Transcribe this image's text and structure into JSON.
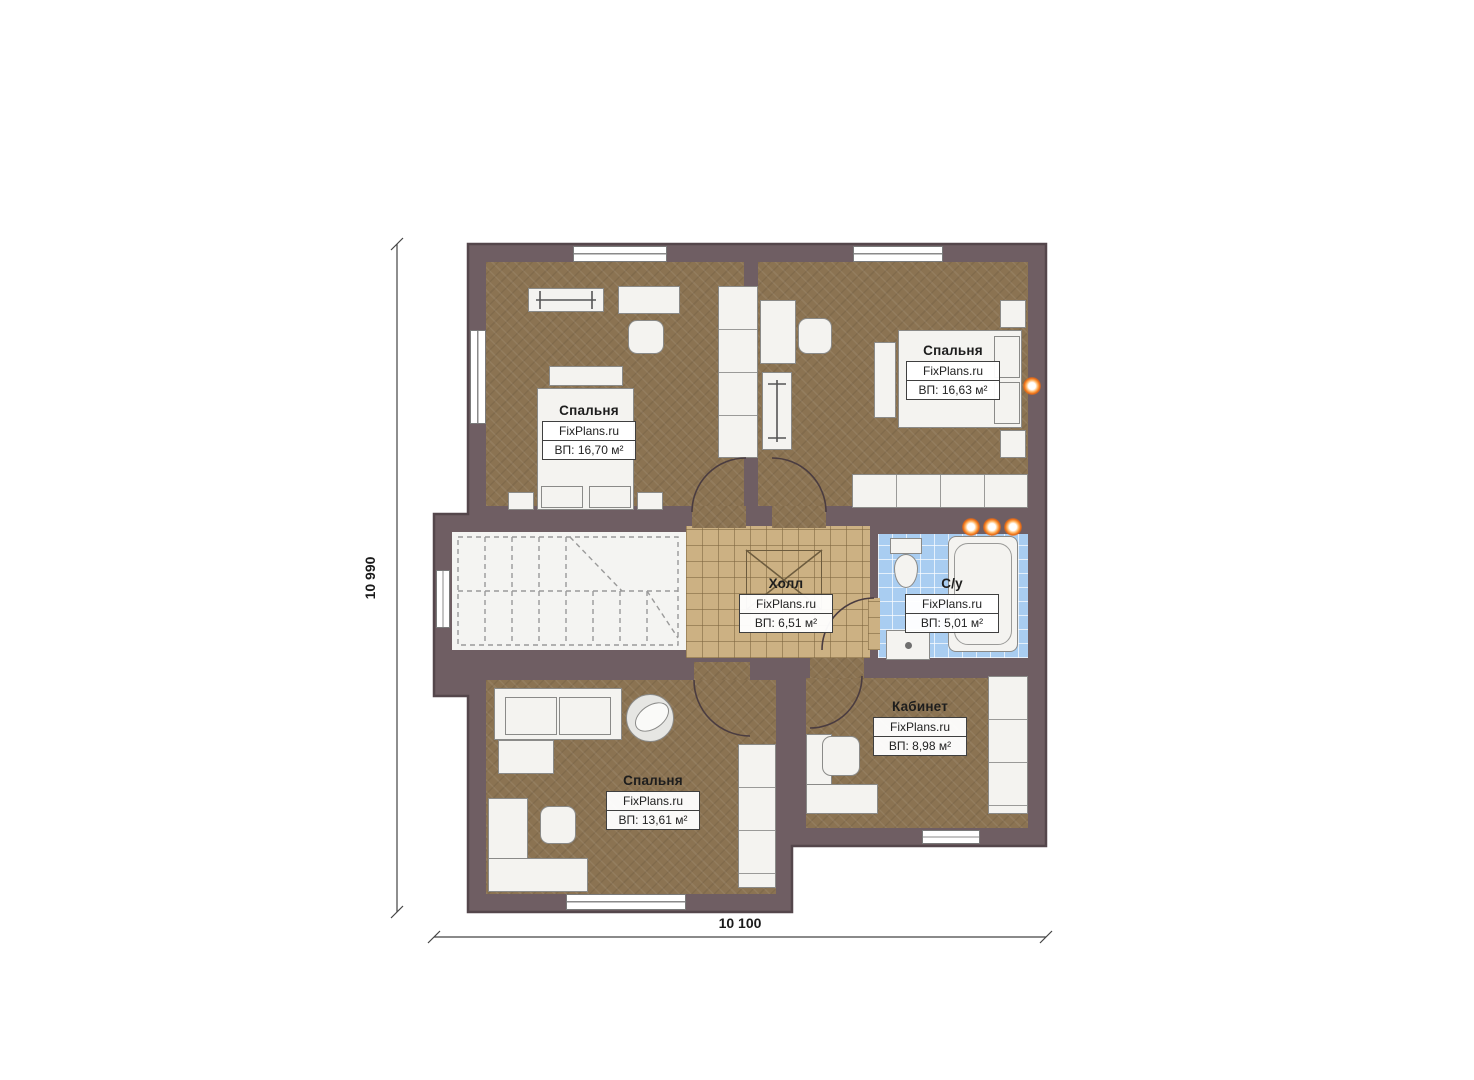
{
  "plan": {
    "type": "floor-plan",
    "language": "ru",
    "brand": "FixPlans.ru"
  },
  "colors": {
    "wall": "#6f5e63",
    "wall_outline": "#54464b",
    "floor_brown": "#8b7352",
    "floor_hall": "#ccb183",
    "floor_bath": "#a9cdf1",
    "floor_stairs": "#f4f4f2",
    "furniture": "#f4f3f0",
    "furniture_border": "#8a8a88",
    "accent_orange": "#ea6a12",
    "line": "#444444"
  },
  "dimensions": {
    "height_label": "10 990",
    "width_label": "10 100"
  },
  "rooms": {
    "bedroom_tl": {
      "name": "Спальня",
      "brand": "FixPlans.ru",
      "area": "ВП: 16,70 м²"
    },
    "bedroom_tr": {
      "name": "Спальня",
      "brand": "FixPlans.ru",
      "area": "ВП: 16,63 м²"
    },
    "hall": {
      "name": "Холл",
      "brand": "FixPlans.ru",
      "area": "ВП: 6,51 м²"
    },
    "bathroom": {
      "name": "С/у",
      "brand": "FixPlans.ru",
      "area": "ВП: 5,01 м²"
    },
    "office": {
      "name": "Кабинет",
      "brand": "FixPlans.ru",
      "area": "ВП: 8,98 м²"
    },
    "bedroom_bl": {
      "name": "Спальня",
      "brand": "FixPlans.ru",
      "area": "ВП: 13,61 м²"
    }
  },
  "furniture": {
    "bedroom_tl": [
      "bed",
      "headboard",
      "nightstands",
      "desk",
      "chair",
      "wardrobe",
      "exercise-bench",
      "window"
    ],
    "bedroom_tr": [
      "bed",
      "pillows",
      "nightstands",
      "bedside-shelf",
      "desk",
      "chair",
      "exercise-bench",
      "wardrobe-row",
      "window",
      "wall-light"
    ],
    "hall": [
      "ceiling-hatch"
    ],
    "bathroom": [
      "toilet",
      "bathtub",
      "sink",
      "spotlights"
    ],
    "office": [
      "corner-desk",
      "chair",
      "wardrobe",
      "window"
    ],
    "bedroom_bl": [
      "sofa",
      "round-plant",
      "shelf",
      "corner-desk",
      "chair",
      "wardrobe",
      "window"
    ],
    "stairwell": [
      "dashed-staircase",
      "window"
    ]
  }
}
